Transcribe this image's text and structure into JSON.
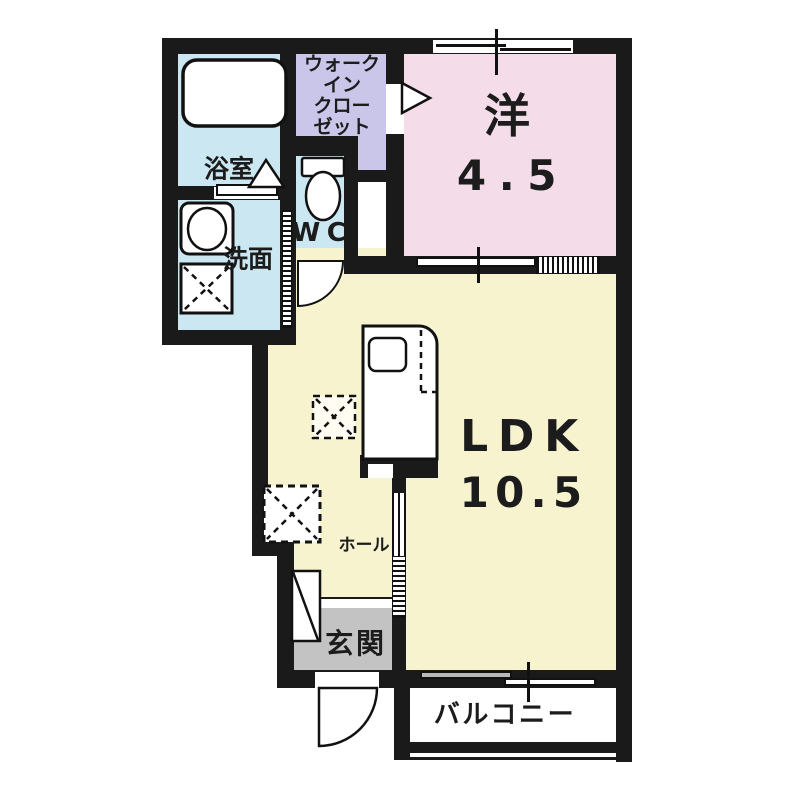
{
  "floorplan": {
    "title": "1LDK apartment floor plan",
    "colors": {
      "wall": "#1a1a1a",
      "western_room": "#f4dde9",
      "walk_in_closet": "#c9c6e9",
      "wet_area": "#cbe7f1",
      "ldk": "#f7f3cf",
      "entrance": "#c3c3c3",
      "balcony": "#ffffff"
    },
    "rooms": {
      "bathroom": {
        "label": "浴室"
      },
      "wic": {
        "lines": [
          "ウォーク",
          "イン",
          "クロー",
          "ゼット"
        ]
      },
      "western": {
        "label": "洋",
        "size": "4.5"
      },
      "washroom": {
        "label": "洗面"
      },
      "wc": {
        "label": "WC"
      },
      "ldk": {
        "label": "LDK",
        "size": "10.5"
      },
      "hall": {
        "label": "ホール"
      },
      "entrance": {
        "label": "玄関"
      },
      "balcony": {
        "label": "バルコニー"
      }
    },
    "fixtures": [
      "bathtub",
      "washbasin",
      "toilet",
      "kitchen-counter",
      "kitchen-sink",
      "refrigerator-space",
      "washing-machine-space",
      "shoe-cabinet"
    ]
  }
}
